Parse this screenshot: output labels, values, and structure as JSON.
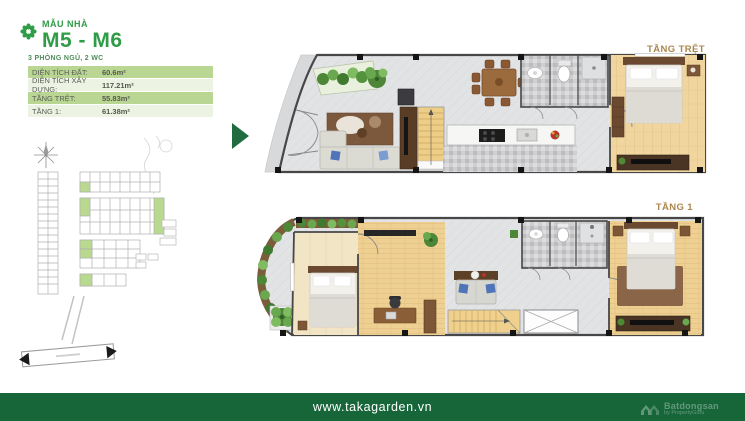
{
  "header": {
    "logo_icon": "flower-pinwheel-icon",
    "eyebrow": "MẪU NHÀ",
    "title": "M5 - M6",
    "subtitle": "3 PHÒNG NGỦ, 2 WC",
    "specs": [
      {
        "label": "DIỆN TÍCH ĐẤT:",
        "value": "60.6m²"
      },
      {
        "label": "DIỆN TÍCH XÂY DỰNG:",
        "value": "117.21m²"
      },
      {
        "label": "TẦNG TRỆT:",
        "value": "55.83m²"
      },
      {
        "label": "TẦNG 1:",
        "value": "61.38m²"
      }
    ]
  },
  "floor_plans": [
    {
      "label": "TẦNG TRỆT"
    },
    {
      "label": "TẦNG 1"
    }
  ],
  "site_map": {
    "compass_icon": "compass-star-icon",
    "plot_highlight_color": "#b9d98f"
  },
  "footer": {
    "url": "www.takagarden.vn",
    "watermark": {
      "brand": "Batdongsan",
      "byline": "by PropertyGuru"
    }
  },
  "colors": {
    "brand_green": "#2f9c47",
    "footer_green": "#17663a",
    "table_row_green": "#b9d693",
    "table_row_pale": "#edf3e2",
    "floor_label_brown": "#aa874e",
    "entry_arrow_green": "#216b40",
    "wood_floor": "#f0d69e",
    "tile_floor": "#e2e3e5"
  }
}
